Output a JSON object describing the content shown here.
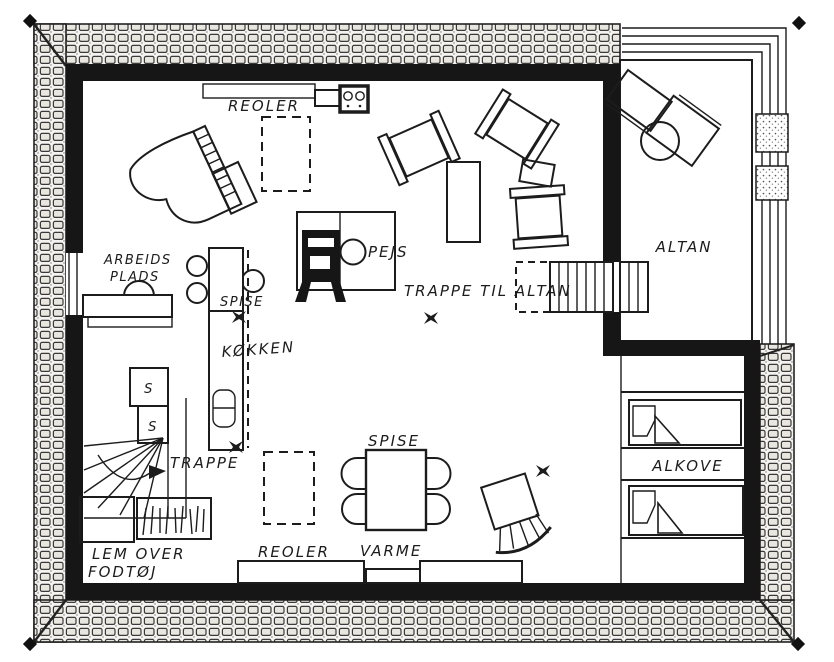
{
  "drawing": {
    "type": "floor-plan",
    "ink_color": "#1c1c1c",
    "paper_color": "#ffffff"
  },
  "labels": {
    "reoler_top": "REOLER",
    "arbejdsplads_line1": "ARBEIDS",
    "arbejdsplads_line2": "PLADS",
    "spise_upper": "SPISE",
    "kokken": "KØKKEN",
    "pejs": "PEJS",
    "trappe_til_altan": "TRAPPE TIL ALTAN",
    "altan": "ALTAN",
    "skab_top": "S",
    "skab_bottom": "S",
    "trappe": "TRAPPE",
    "spise_lower": "SPISE",
    "alkove": "ALKOVE",
    "lem_line1": "LEM OVER",
    "lem_line2": "FODTØJ",
    "reoler_bottom": "REOLER",
    "varme": "VARME"
  }
}
